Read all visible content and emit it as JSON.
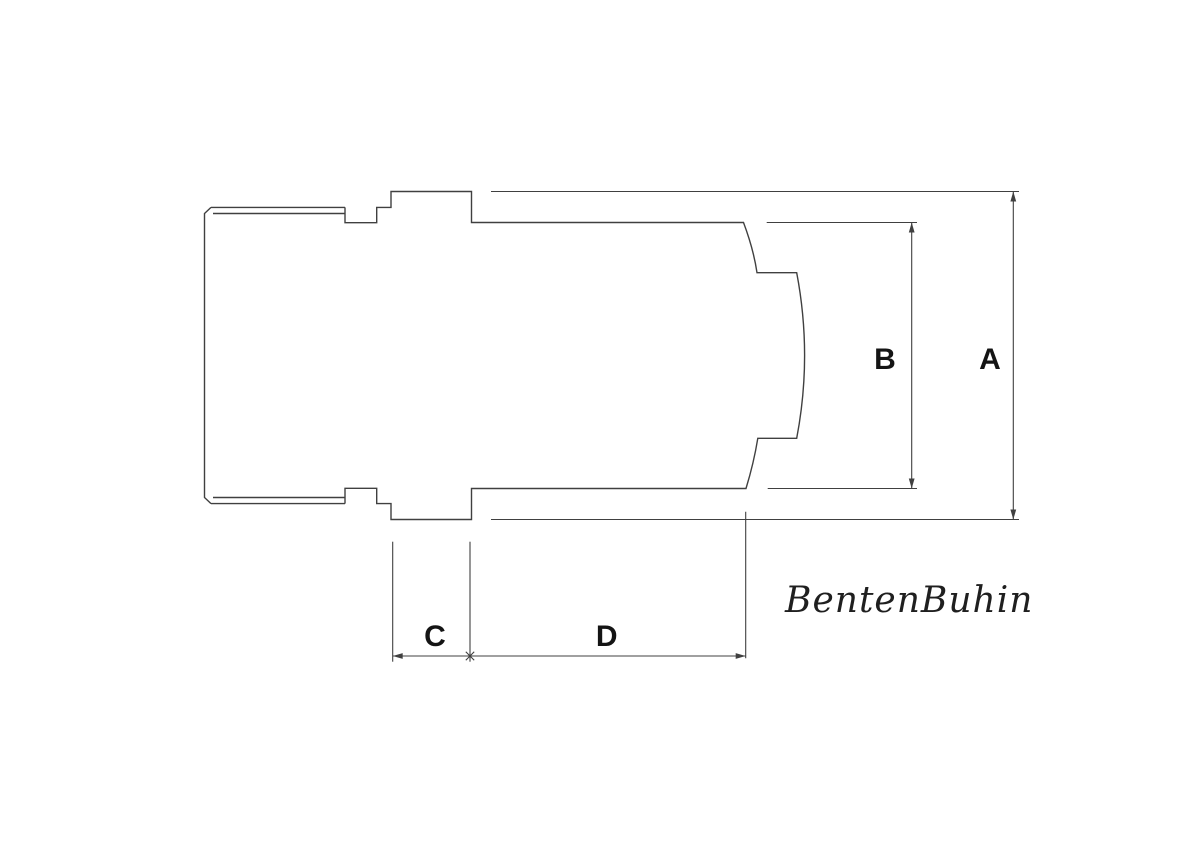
{
  "page": {
    "background": "#ffffff"
  },
  "drawing": {
    "line_color": "#404040",
    "label_color": "#141414",
    "signature_color": "#1f1f1f",
    "labels": {
      "a": "A",
      "b": "B",
      "c": "C",
      "d": "D"
    },
    "signature": "BentenBuhin",
    "dimensions": [
      {
        "label": "A",
        "orientation": "vertical"
      },
      {
        "label": "B",
        "orientation": "vertical"
      },
      {
        "label": "C",
        "orientation": "horizontal"
      },
      {
        "label": "D",
        "orientation": "horizontal"
      }
    ]
  }
}
